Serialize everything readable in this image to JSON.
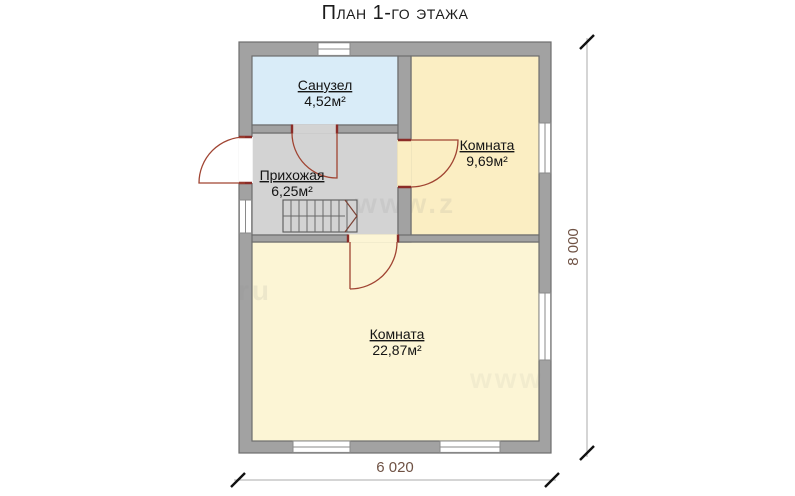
{
  "title": "План 1-го этажа",
  "rooms": [
    {
      "name": "Санузел",
      "area": "4,52м²"
    },
    {
      "name": "Комната",
      "area": "9,69м²"
    },
    {
      "name": "Прихожая",
      "area": "6,25м²"
    },
    {
      "name": "Комната",
      "area": "22,87м²"
    }
  ],
  "dimensions": {
    "vertical": "8 000",
    "horizontal": "6 020"
  },
  "watermark": [
    "www.z",
    "ru",
    "www"
  ],
  "colors": {
    "wall_fill": "#a2a2a2",
    "wall_stroke": "#6e6e6e",
    "bathroom_floor": "#d9ecf8",
    "hallway_floor": "#d3d3d3",
    "room_small_floor": "#fbeec3",
    "room_large_floor": "#fcf5d5",
    "door_arc": "#a04432",
    "dim_text": "#6f5244"
  }
}
